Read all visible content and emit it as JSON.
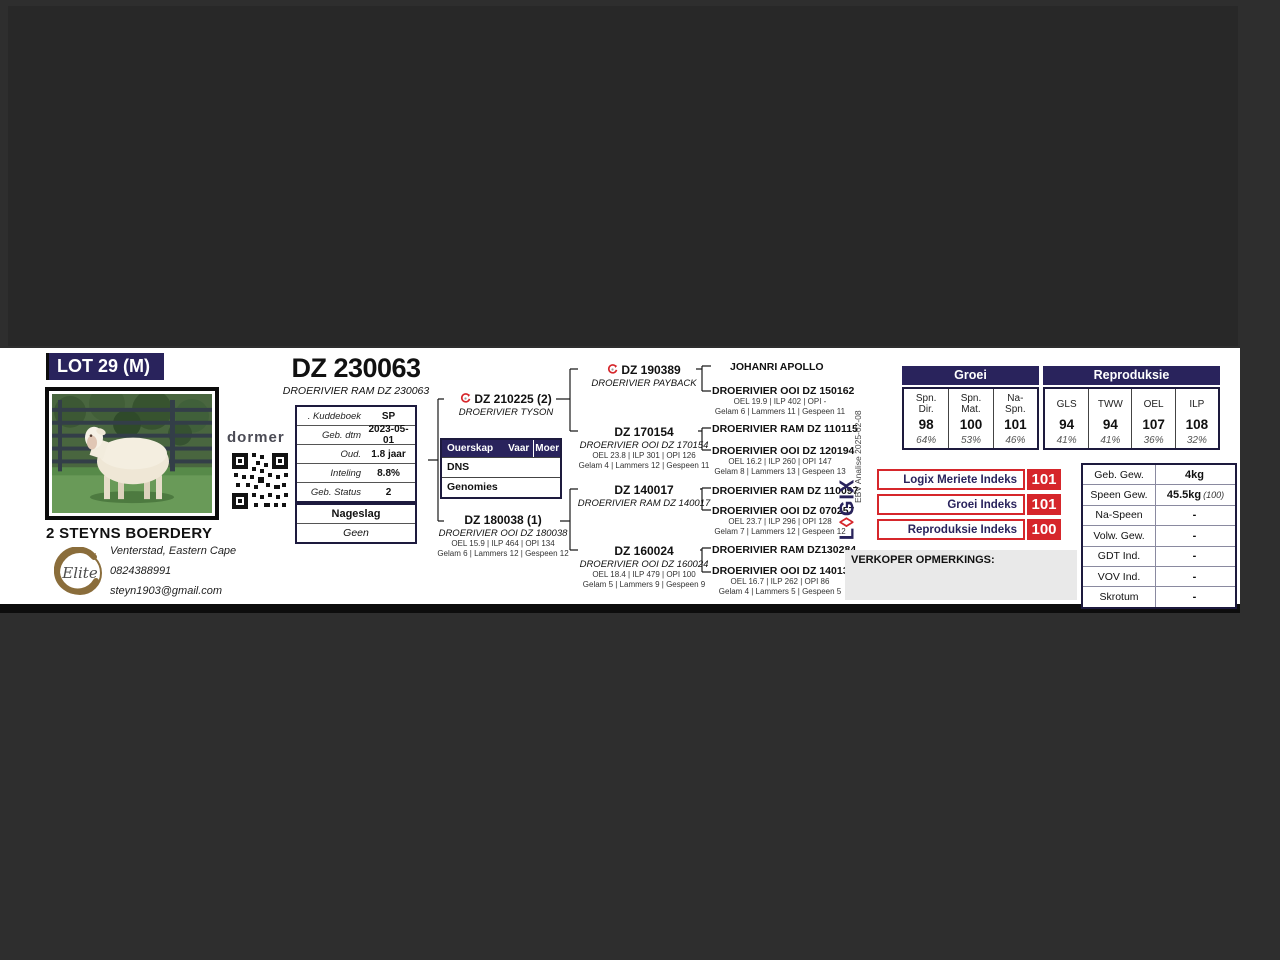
{
  "page": {
    "lot_label": "LOT 29 (M)"
  },
  "title": {
    "main": "DZ 230063",
    "subtitle": "DROERIVIER RAM DZ 230063"
  },
  "breeder": {
    "name": "2 STEYNS BOERDERY",
    "location": "Venterstad, Eastern Cape",
    "phone": "0824388991",
    "email": "steyn1903@gmail.com"
  },
  "brand": {
    "dormer_label": "dormer"
  },
  "info_table": {
    "rows": [
      {
        "label": ". Kuddeboek",
        "value": "SP"
      },
      {
        "label": "Geb. dtm",
        "value": "2023-05-01"
      },
      {
        "label": "Oud.",
        "value": "1.8 jaar"
      },
      {
        "label": "Inteling",
        "value": "8.8%"
      },
      {
        "label": "Geb. Status",
        "value": "2"
      }
    ]
  },
  "nageslag": {
    "header": "Nageslag",
    "value": "Geen"
  },
  "ouerskap": {
    "col1": "Ouerskap",
    "col2": "Vaar",
    "col3": "Moer",
    "rows": [
      {
        "label": "DNS"
      },
      {
        "label": "Genomies"
      }
    ]
  },
  "pedigree": {
    "sire": {
      "id": "DZ 210225 (2)",
      "name": "DROERIVIER TYSON"
    },
    "dam": {
      "id": "DZ 180038 (1)",
      "name": "DROERIVIER OOI DZ 180038",
      "stats1": "OEL 15.9 | ILP 464 | OPI 134",
      "stats2": "Gelam 6 | Lammers 12 | Gespeen 12"
    },
    "gen2": [
      {
        "id": "DZ 190389",
        "name": "DROERIVIER PAYBACK",
        "stats1": "",
        "stats2": ""
      },
      {
        "id": "DZ 170154",
        "name": "DROERIVIER OOI DZ 170154",
        "stats1": "OEL 23.8 | ILP 301 | OPI 126",
        "stats2": "Gelam 4 | Lammers 12 | Gespeen 11"
      },
      {
        "id": "DZ 140017",
        "name": "DROERIVIER RAM DZ 140017",
        "stats1": "",
        "stats2": ""
      },
      {
        "id": "DZ 160024",
        "name": "DROERIVIER OOI DZ 160024",
        "stats1": "OEL 18.4 | ILP 479 | OPI 100",
        "stats2": "Gelam 5 | Lammers 9 | Gespeen 9"
      }
    ],
    "gen3": [
      {
        "name": "JOHANRI APOLLO",
        "stats1": "",
        "stats2": ""
      },
      {
        "name": "DROERIVIER OOI DZ 150162",
        "stats1": "OEL 19.9 | ILP 402 | OPI -",
        "stats2": "Gelam 6 | Lammers 11 | Gespeen 11"
      },
      {
        "name": "DROERIVIER RAM DZ 110115",
        "stats1": "",
        "stats2": ""
      },
      {
        "name": "DROERIVIER OOI DZ 120194",
        "stats1": "OEL 16.2 | ILP 260 | OPI 147",
        "stats2": "Gelam 8 | Lammers 13 | Gespeen 13"
      },
      {
        "name": "DROERIVIER RAM DZ 110097",
        "stats1": "",
        "stats2": ""
      },
      {
        "name": "DROERIVIER OOI DZ 070257",
        "stats1": "OEL 23.7 | ILP 296 | OPI 128",
        "stats2": "Gelam 7 | Lammers 12 | Gespeen 12"
      },
      {
        "name": "DROERIVIER RAM DZ130284",
        "stats1": "",
        "stats2": ""
      },
      {
        "name": "DROERIVIER OOI DZ 140130",
        "stats1": "OEL 16.7 | ILP 262 | OPI 86",
        "stats2": "Gelam 4 | Lammers 5 | Gespeen 5"
      }
    ]
  },
  "ebv": {
    "groei_header": "Groei",
    "repro_header": "Reproduksie",
    "groei_cols": [
      {
        "l1": "Spn.",
        "l2": "Dir.",
        "value": "98",
        "acc": "64%"
      },
      {
        "l1": "Spn.",
        "l2": "Mat.",
        "value": "100",
        "acc": "53%"
      },
      {
        "l1": "Na-",
        "l2": "Spn.",
        "value": "101",
        "acc": "46%"
      }
    ],
    "repro_cols": [
      {
        "l1": "GLS",
        "l2": "",
        "value": "94",
        "acc": "41%"
      },
      {
        "l1": "TWW",
        "l2": "",
        "value": "94",
        "acc": "41%"
      },
      {
        "l1": "OEL",
        "l2": "",
        "value": "107",
        "acc": "36%"
      },
      {
        "l1": "ILP",
        "l2": "",
        "value": "108",
        "acc": "32%"
      }
    ]
  },
  "indexes": {
    "rows": [
      {
        "label": "Logix Meriete Indeks",
        "value": "101"
      },
      {
        "label": "Groei Indeks",
        "value": "101"
      },
      {
        "label": "Reproduksie Indeks",
        "value": "100"
      }
    ]
  },
  "logix": {
    "wordmark": "LOGIX",
    "analysis_note": "EBV Analise 2025-02-08"
  },
  "weights": {
    "rows": [
      {
        "label": "Geb. Gew.",
        "value": "4kg",
        "note": ""
      },
      {
        "label": "Speen Gew.",
        "value": "45.5kg",
        "note": "(100)"
      },
      {
        "label": "Na-Speen",
        "value": "-",
        "note": ""
      },
      {
        "label": "Volw. Gew.",
        "value": "-",
        "note": ""
      },
      {
        "label": "GDT Ind.",
        "value": "-",
        "note": ""
      },
      {
        "label": "VOV Ind.",
        "value": "-",
        "note": ""
      },
      {
        "label": "Skrotum",
        "value": "-",
        "note": ""
      }
    ]
  },
  "verkoper": {
    "label": "VERKOPER OPMERKINGS:"
  },
  "colors": {
    "navy": "#29235C",
    "red": "#D6262B",
    "page_bg": "#2E2E2E",
    "card_bg": "#FFFFFF",
    "notes_bg": "#E9E9E9"
  }
}
